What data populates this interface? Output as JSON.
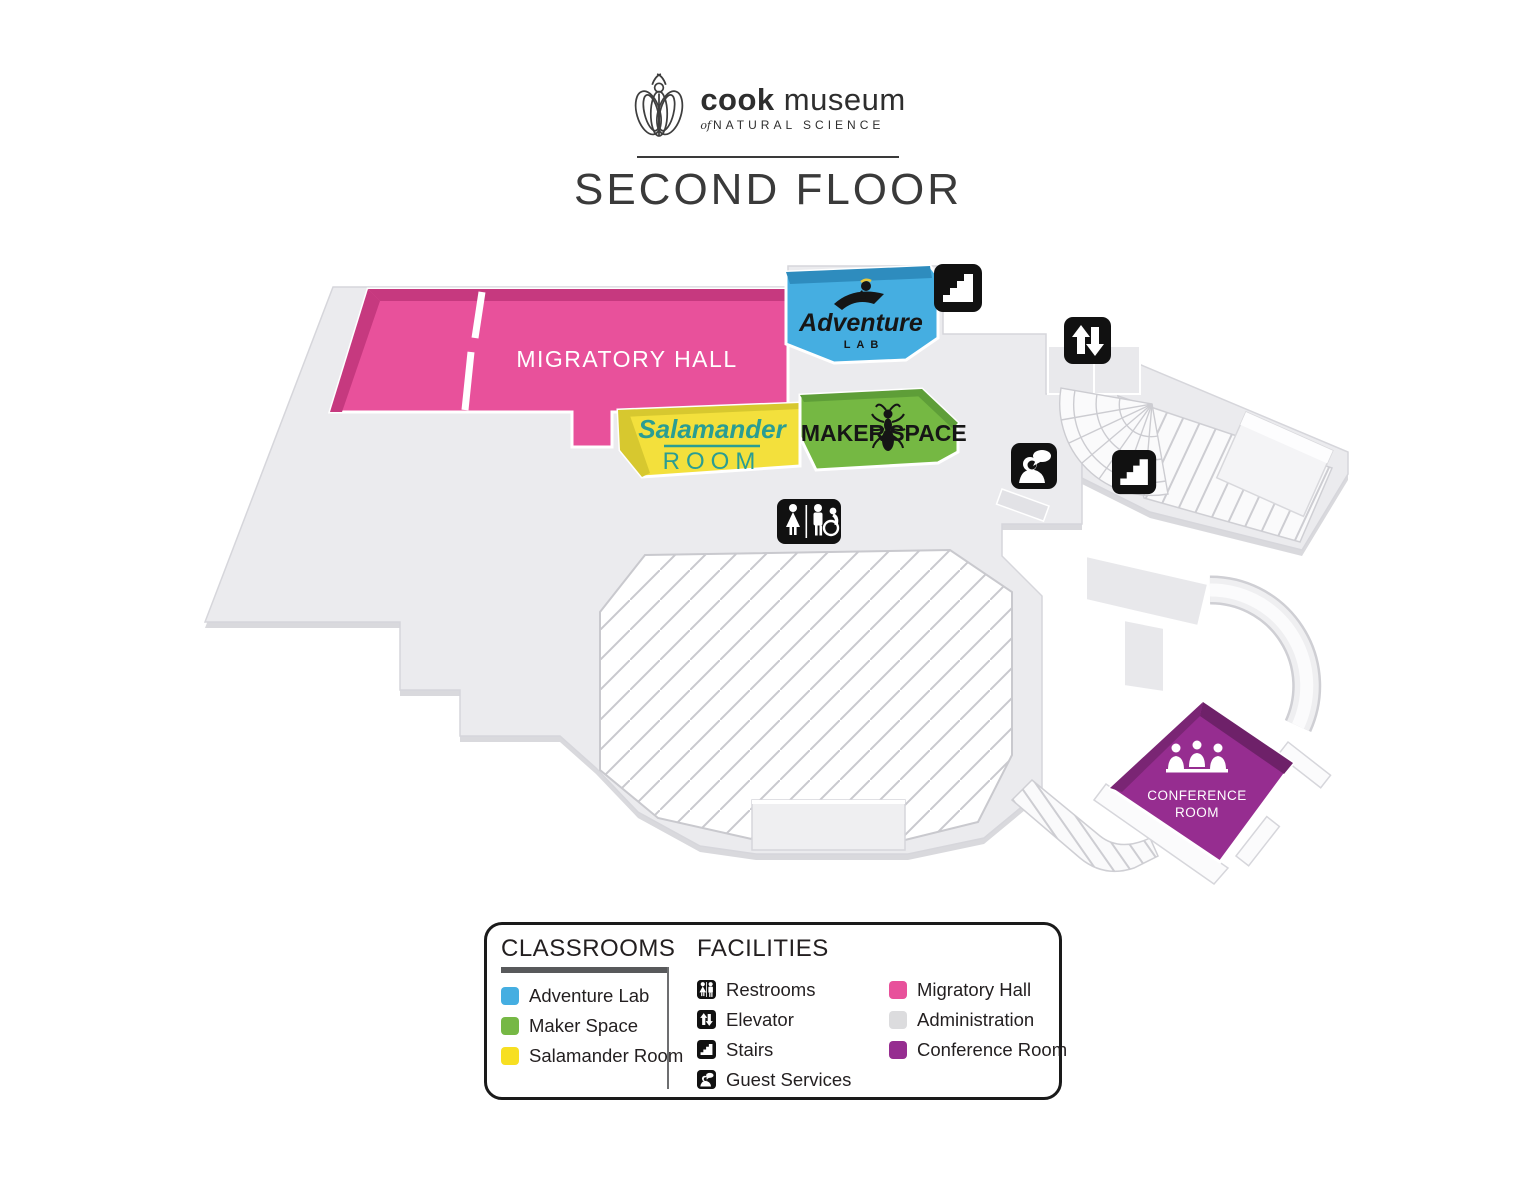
{
  "header": {
    "brand_bold": "cook",
    "brand_regular": "museum",
    "brand_of": "of",
    "brand_subtitle": "NATURAL SCIENCE",
    "title": "SECOND FLOOR"
  },
  "map": {
    "rooms": {
      "migratory_hall": {
        "label": "MIGRATORY HALL",
        "color": "#E8519B",
        "text_color": "#FFFFFF"
      },
      "adventure_lab": {
        "script": "Adventure",
        "sub": "LAB",
        "color": "#45AEE1",
        "text_color": "#161616"
      },
      "maker_space": {
        "word_left": "MAKER",
        "word_right": "SPACE",
        "color": "#75B843",
        "text_color": "#161616"
      },
      "salamander_room": {
        "script": "Salamander",
        "sub": "ROOM",
        "color": "#F3E03C",
        "text_color": "#2A9D93"
      },
      "conference_room": {
        "line1": "CONFERENCE",
        "line2": "ROOM",
        "color": "#962D90",
        "text_color": "#FFFFFF"
      },
      "administration": {
        "color": "#EBEBEE"
      }
    },
    "icons": {
      "stairs_upper": "stairs-icon",
      "elevator": "elevator-icon",
      "guest_services": "guest-services-icon",
      "stairs_lower": "stairs-icon",
      "restrooms": "restrooms-icon"
    }
  },
  "legend": {
    "classrooms": {
      "title": "CLASSROOMS",
      "items": [
        {
          "label": "Adventure Lab",
          "color": "#45AEE1"
        },
        {
          "label": "Maker Space",
          "color": "#76B845"
        },
        {
          "label": "Salamander Room",
          "color": "#F7DF22"
        }
      ]
    },
    "facilities": {
      "title": "FACILITIES",
      "icon_items": [
        {
          "label": "Restrooms",
          "icon": "restrooms-icon"
        },
        {
          "label": "Elevator",
          "icon": "elevator-icon"
        },
        {
          "label": "Stairs",
          "icon": "stairs-icon"
        },
        {
          "label": "Guest Services",
          "icon": "guest-services-icon"
        }
      ],
      "color_items": [
        {
          "label": "Migratory Hall",
          "color": "#E8519B"
        },
        {
          "label": "Administration",
          "color": "#DCDCDE"
        },
        {
          "label": "Conference Room",
          "color": "#962D90"
        }
      ]
    }
  }
}
